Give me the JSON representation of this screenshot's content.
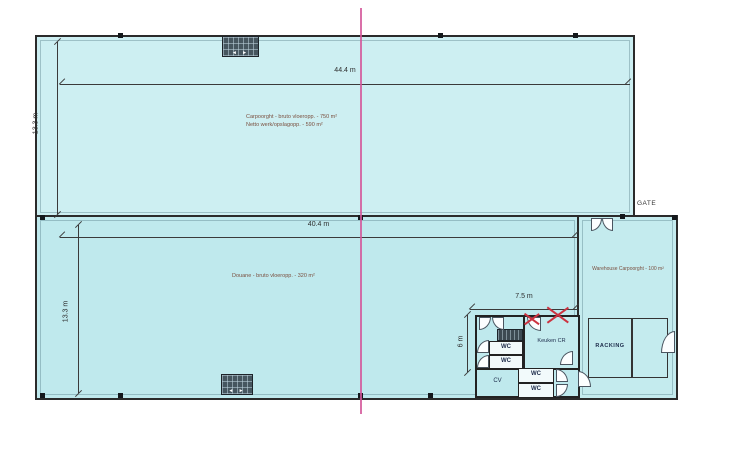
{
  "plan": {
    "gate_label": "GATE",
    "dimensions": {
      "upper_width": "44.4 m",
      "upper_height": "13.3 m",
      "lower_width": "40.4 m",
      "lower_height": "13.3 m",
      "annex_width": "7.5 m",
      "annex_height": "6 m"
    },
    "rooms": {
      "upper_hall_line1": "Carpoorght - bruto vloeropp. - 750 m²",
      "upper_hall_line2": "Netto werk/opslagopp. - 590 m²",
      "lower_hall": "Douane - bruto vloeropp. - 320 m²",
      "warehouse": "Warehouse Carpoorght - 100 m²",
      "racking": "RACKING",
      "kitchen": "Keuken CR",
      "wc": "WC",
      "cv": "CV"
    },
    "symbols": {
      "gate_arrows": "◄ ►"
    },
    "colors": {
      "floor_fill_upper": "#cdeff2",
      "floor_fill_lower": "#bfe9ed",
      "wall": "#2b2b2b",
      "fold_line": "#d4579a",
      "cross_mark": "#cc3340",
      "hall_text": "#7a4f3f",
      "room_text": "#1c2b4a"
    }
  }
}
